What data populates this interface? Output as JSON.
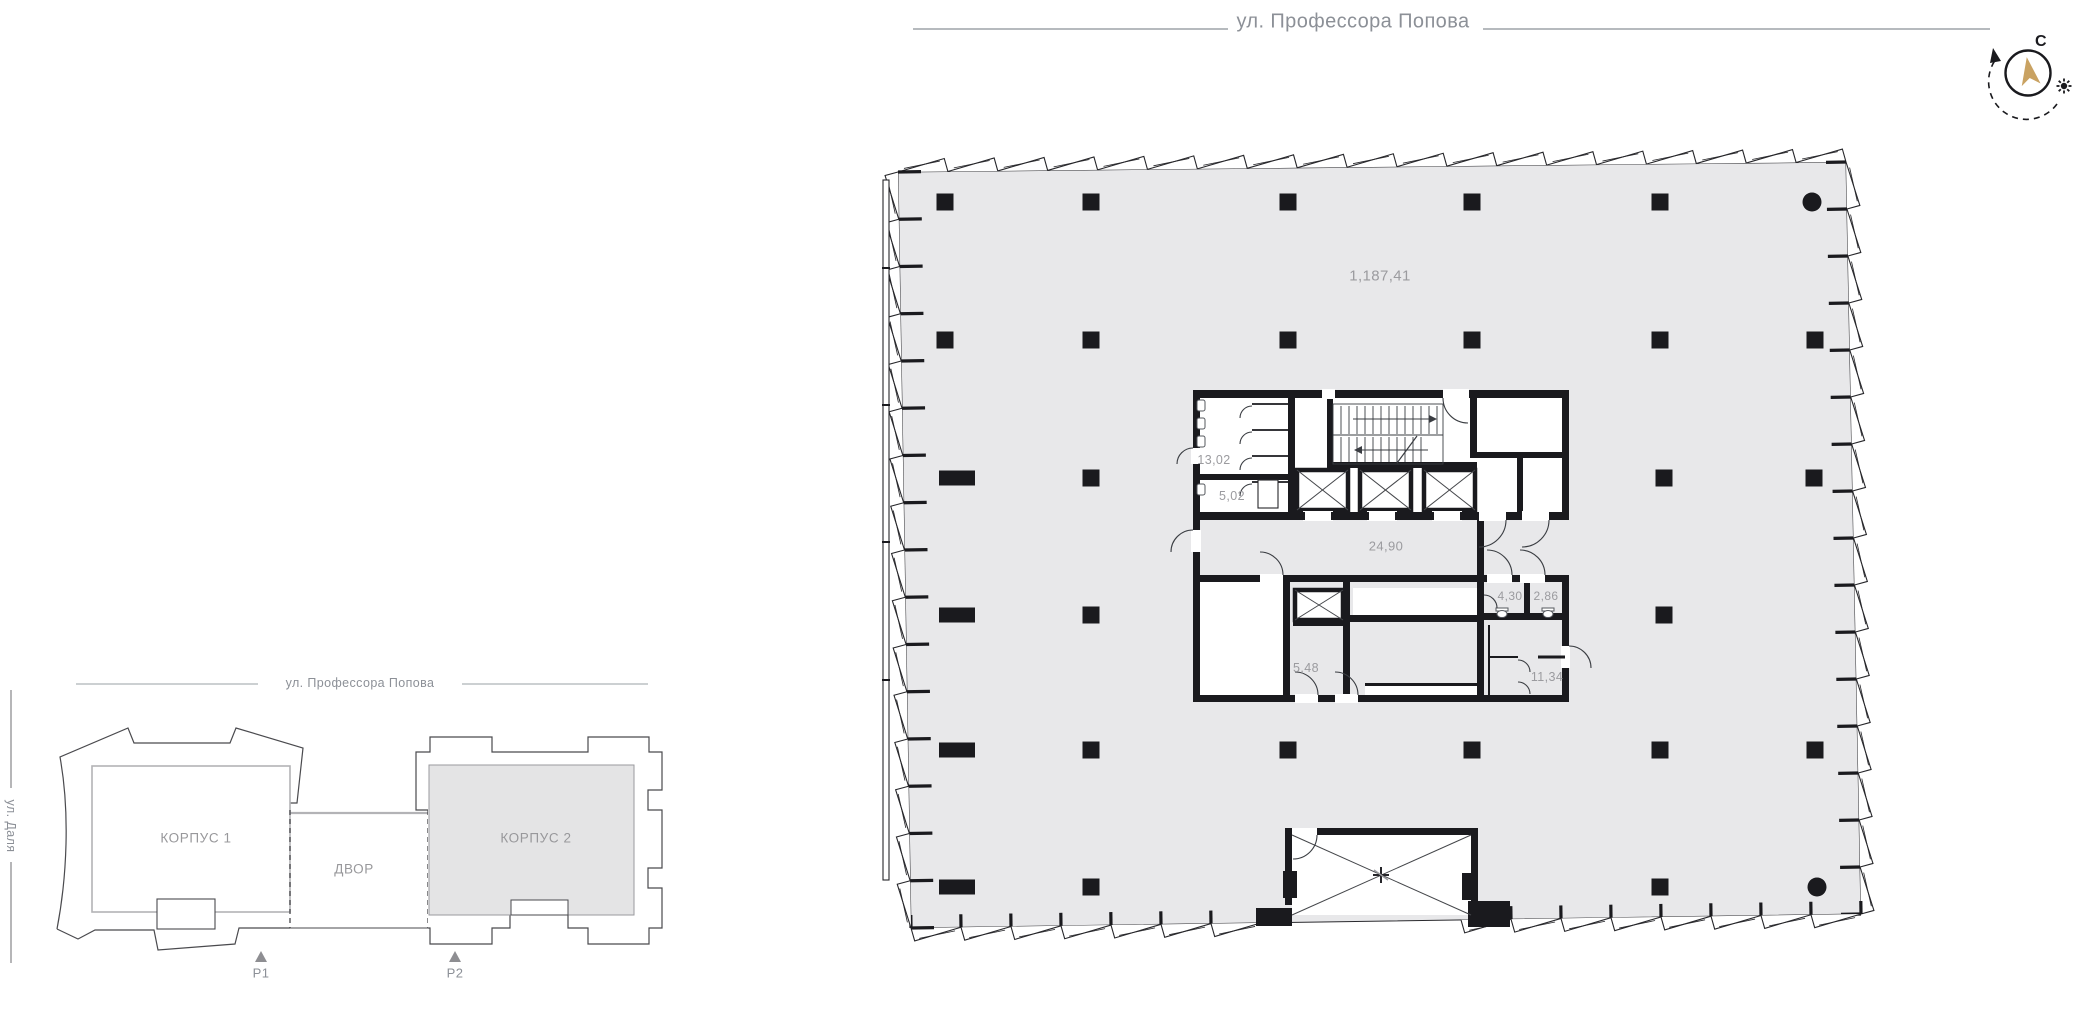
{
  "streets": {
    "top": "ул. Профессора Попова",
    "site": "ул. Профессора Попова",
    "left": "ул. Даля"
  },
  "compass": {
    "north": "С"
  },
  "site_plan": {
    "building1": "КОРПУС 1",
    "building2": "КОРПУС 2",
    "courtyard": "ДВОР",
    "p1": "P1",
    "p2": "P2"
  },
  "areas": {
    "open_space": "1,187,41",
    "wc": "13,02",
    "wc_small": "5,02",
    "lobby": "24,90",
    "r430": "4,30",
    "r286": "2,86",
    "r548": "5,48",
    "r1134": "11,34"
  },
  "colors": {
    "floor": "#e8e8ea",
    "wall": "#1a1a1e",
    "label": "#9b9b9f",
    "street": "#8c9097",
    "accent": "#c9a262"
  }
}
